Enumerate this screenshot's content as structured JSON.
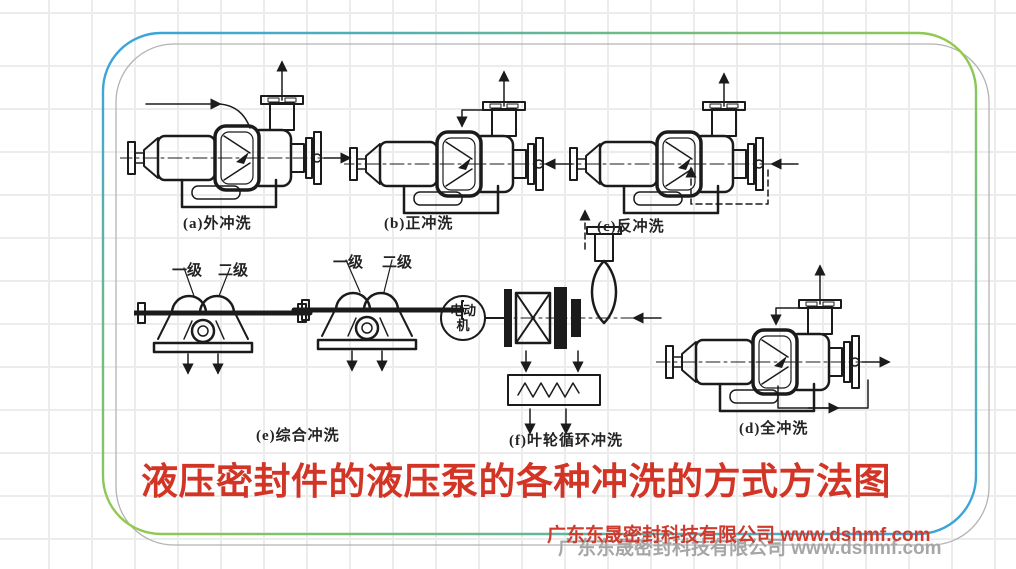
{
  "slide": {
    "title": "液压密封件的液压泵的各种冲洗的方式方法图",
    "watermark": "广东东晟密封科技有限公司  www.dshmf.com"
  },
  "diagrams": {
    "a": {
      "label": "(a)外冲洗"
    },
    "b": {
      "label": "(b)正冲洗"
    },
    "c": {
      "label": "(c)反冲洗"
    },
    "d": {
      "label": "(d)全冲洗"
    },
    "e": {
      "label": "(e)综合冲洗",
      "stage1": "一级",
      "stage2": "二级"
    },
    "f": {
      "label": "(f)叶轮循环冲洗",
      "motor_line1": "电动",
      "motor_line2": "机"
    }
  },
  "colors": {
    "frame_blue": "#35a2e3",
    "frame_green": "#94ca4c",
    "frame_gray": "#b3b3b3",
    "grid_gray": "#ececec",
    "title_red": "#d23526",
    "watermark_red": "#cf3a2e",
    "watermark_gray": "#a6a6a6",
    "diagram_ink": "#1b1b1b"
  }
}
